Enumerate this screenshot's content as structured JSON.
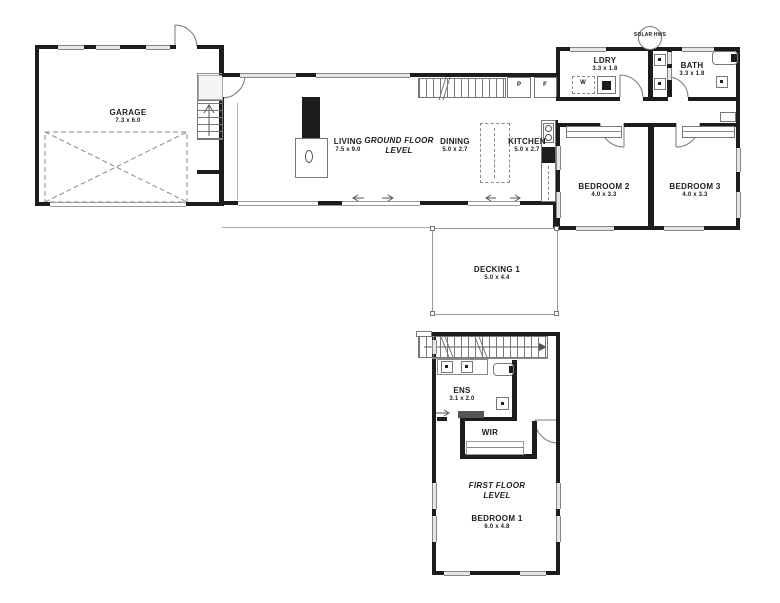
{
  "rooms": {
    "garage": {
      "name": "GARAGE",
      "dims": "7.3 x 6.0"
    },
    "living": {
      "name": "LIVING",
      "dims": "7.5 x 9.0"
    },
    "ground_floor": {
      "line1": "GROUND FLOOR",
      "line2": "LEVEL"
    },
    "dining": {
      "name": "DINING",
      "dims": "5.0 x 2.7"
    },
    "kitchen": {
      "name": "KITCHEN",
      "dims": "5.0 x 2.7"
    },
    "ldry": {
      "name": "LDRY",
      "dims": "3.3 x 1.8"
    },
    "bath": {
      "name": "BATH",
      "dims": "3.3 x 1.8"
    },
    "bedroom2": {
      "name": "BEDROOM 2",
      "dims": "4.0 x 3.3"
    },
    "bedroom3": {
      "name": "BEDROOM 3",
      "dims": "4.0 x 3.3"
    },
    "decking": {
      "name": "DECKING 1",
      "dims": "5.0 x 4.4"
    },
    "ens": {
      "name": "ENS",
      "dims": "3.1 x 2.0"
    },
    "wir": {
      "name": "WIR"
    },
    "first_floor": {
      "line1": "FIRST FLOOR",
      "line2": "LEVEL"
    },
    "bedroom1": {
      "name": "BEDROOM 1",
      "dims": "6.0 x 4.8"
    }
  },
  "fixtures": {
    "pantry": "P",
    "fridge": "F",
    "washer": "W",
    "solar_hws": "SOLAR HWS"
  }
}
